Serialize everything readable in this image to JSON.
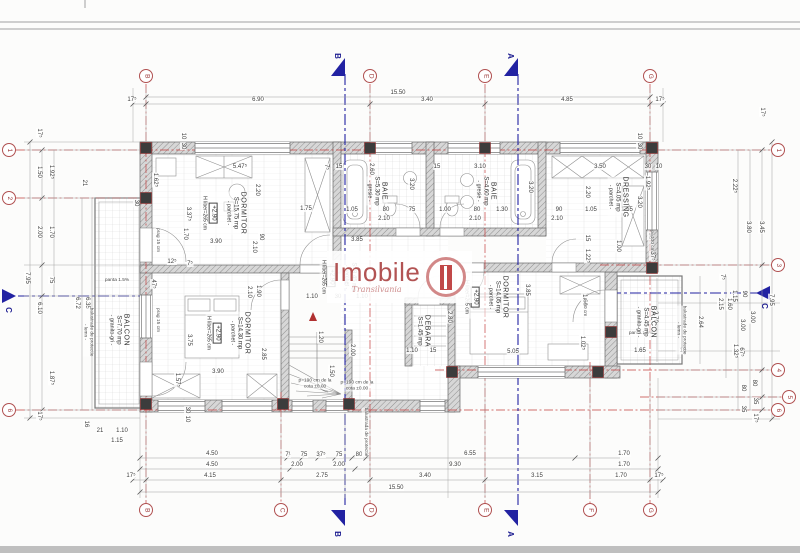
{
  "logo": {
    "name": "Imobile",
    "subtitle": "Transilvania"
  },
  "colors": {
    "grid_line": "#c24040",
    "section_line": "#2222a2",
    "bubble_stroke": "#b05050",
    "logo_red": "#b25353",
    "wall_gray": "#d7d7d7",
    "dim_text": "#3d3d3d"
  },
  "grid": {
    "top": [
      {
        "label": "B",
        "x": 146
      },
      {
        "label": "D",
        "x": 370
      },
      {
        "label": "E",
        "x": 485
      },
      {
        "label": "G",
        "x": 650
      }
    ],
    "bottom": [
      {
        "label": "B",
        "x": 146
      },
      {
        "label": "C",
        "x": 281
      },
      {
        "label": "D",
        "x": 370
      },
      {
        "label": "E",
        "x": 485
      },
      {
        "label": "F",
        "x": 590
      },
      {
        "label": "G",
        "x": 650
      }
    ],
    "left": [
      {
        "label": "1",
        "y": 150
      },
      {
        "label": "2",
        "y": 198
      },
      {
        "label": "6",
        "y": 410
      }
    ],
    "right": [
      {
        "label": "1",
        "y": 150,
        "x": 778
      },
      {
        "label": "3",
        "y": 265,
        "x": 778
      },
      {
        "label": "4",
        "y": 370,
        "x": 778
      },
      {
        "label": "5",
        "y": 397,
        "x": 789
      },
      {
        "label": "6",
        "y": 410,
        "x": 778
      }
    ]
  },
  "sections": [
    {
      "label": "B",
      "side": "top",
      "x": 345
    },
    {
      "label": "A",
      "side": "top",
      "x": 518
    },
    {
      "label": "B",
      "side": "bottom",
      "x": 345
    },
    {
      "label": "A",
      "side": "bottom",
      "x": 518
    },
    {
      "label": "C",
      "side": "left",
      "y": 296
    },
    {
      "label": "C",
      "side": "right",
      "y": 293
    }
  ],
  "rooms": [
    {
      "name": "DORMITOR",
      "area": "S=15.75 mp",
      "finish": "- parchet -",
      "level": "+2.90",
      "height": "H liber=265 cm",
      "x": 224,
      "y": 213
    },
    {
      "name": "BAIE",
      "area": "S=5.30 mp",
      "finish": "- gresie -",
      "x": 377,
      "y": 191
    },
    {
      "name": "BAIE",
      "area": "S=4.60 mp",
      "finish": "- gresie -",
      "x": 486,
      "y": 191
    },
    {
      "name": "DRESSING",
      "area": "S=4.05 mp",
      "finish": "- parchet -",
      "x": 618,
      "y": 197
    },
    {
      "name": "",
      "area": "S=8.45 mp",
      "finish": "- parchet -",
      "level": "+2.90",
      "height": "H liber=265 cm",
      "x": 338,
      "y": 277
    },
    {
      "name": "DORMITOR",
      "area": "S=14.30 mp",
      "finish": "- parchet -",
      "level": "+2.90",
      "height": "H liber=265 cm",
      "x": 228,
      "y": 333
    },
    {
      "name": "DORMITOR",
      "area": "S=14.05 mp",
      "finish": "- parchet -",
      "level": "+2.90",
      "height": "H liber=265 cm",
      "x": 486,
      "y": 297
    },
    {
      "name": "DEBARA",
      "area": "S=1.45 mp",
      "x": 423,
      "y": 331
    },
    {
      "name": "BALCON",
      "area": "S=7.70 mp",
      "finish": "- granito-gri -",
      "x": 119,
      "y": 330
    },
    {
      "name": "BALCON",
      "area": "S=4.45 mp",
      "finish": "- granito-gri -",
      "x": 646,
      "y": 322
    }
  ],
  "dims": [
    {
      "t": "15.50",
      "x": 398,
      "y": 93
    },
    {
      "t": "17⁵",
      "x": 132,
      "y": 100
    },
    {
      "t": "6.90",
      "x": 258,
      "y": 100
    },
    {
      "t": "3.40",
      "x": 427,
      "y": 100
    },
    {
      "t": "4.85",
      "x": 567,
      "y": 100
    },
    {
      "t": "17⁵",
      "x": 660,
      "y": 100
    },
    {
      "t": "4.50",
      "x": 212,
      "y": 454
    },
    {
      "t": "7¹",
      "x": 288,
      "y": 455
    },
    {
      "t": "75",
      "x": 304,
      "y": 455
    },
    {
      "t": "37⁵",
      "x": 321,
      "y": 455
    },
    {
      "t": "75",
      "x": 339,
      "y": 455
    },
    {
      "t": "80",
      "x": 359,
      "y": 455
    },
    {
      "t": "6.55",
      "x": 470,
      "y": 454
    },
    {
      "t": "1.70",
      "x": 624,
      "y": 454
    },
    {
      "t": "4.50",
      "x": 212,
      "y": 465
    },
    {
      "t": "2.00",
      "x": 297,
      "y": 465
    },
    {
      "t": "2.00",
      "x": 339,
      "y": 465
    },
    {
      "t": "9.30",
      "x": 455,
      "y": 465
    },
    {
      "t": "1.70",
      "x": 624,
      "y": 465
    },
    {
      "t": "17⁵",
      "x": 131,
      "y": 476
    },
    {
      "t": "4.15",
      "x": 210,
      "y": 476
    },
    {
      "t": "2.75",
      "x": 322,
      "y": 476
    },
    {
      "t": "3.40",
      "x": 425,
      "y": 476
    },
    {
      "t": "3.15",
      "x": 537,
      "y": 476
    },
    {
      "t": "1.70",
      "x": 621,
      "y": 476
    },
    {
      "t": "17⁵",
      "x": 659,
      "y": 476
    },
    {
      "t": "15.50",
      "x": 396,
      "y": 488
    },
    {
      "t": "17⁵",
      "x": 39,
      "y": 133,
      "r": 1
    },
    {
      "t": "1.50",
      "x": 39,
      "y": 172,
      "r": 1
    },
    {
      "t": "1.92⁵",
      "x": 51,
      "y": 172,
      "r": 1
    },
    {
      "t": "21",
      "x": 84,
      "y": 183,
      "r": 1
    },
    {
      "t": "2.00",
      "x": 39,
      "y": 232,
      "r": 1
    },
    {
      "t": "1.70",
      "x": 51,
      "y": 232,
      "r": 1
    },
    {
      "t": "7.95",
      "x": 27,
      "y": 278,
      "r": 1
    },
    {
      "t": "75",
      "x": 51,
      "y": 280,
      "r": 1
    },
    {
      "t": "6.10",
      "x": 39,
      "y": 308,
      "r": 1
    },
    {
      "t": "6.72",
      "x": 77,
      "y": 303,
      "r": 1
    },
    {
      "t": "6.35",
      "x": 87,
      "y": 303,
      "r": 1
    },
    {
      "t": "1.87⁵",
      "x": 51,
      "y": 378,
      "r": 1
    },
    {
      "t": "17⁵",
      "x": 39,
      "y": 416,
      "r": 1
    },
    {
      "t": "16",
      "x": 86,
      "y": 424,
      "r": 1
    },
    {
      "t": "21",
      "x": 100,
      "y": 431
    },
    {
      "t": "1.10",
      "x": 122,
      "y": 431
    },
    {
      "t": "1.15",
      "x": 117,
      "y": 441
    },
    {
      "t": "17⁵",
      "x": 762,
      "y": 112,
      "r": 1
    },
    {
      "t": "2.22⁵",
      "x": 734,
      "y": 186,
      "r": 1
    },
    {
      "t": "3.80",
      "x": 748,
      "y": 227,
      "r": 1
    },
    {
      "t": "3.45",
      "x": 761,
      "y": 227,
      "r": 1
    },
    {
      "t": "90",
      "x": 744,
      "y": 294,
      "r": 1
    },
    {
      "t": "1.15",
      "x": 734,
      "y": 296,
      "r": 1
    },
    {
      "t": "67⁵",
      "x": 741,
      "y": 352,
      "r": 1
    },
    {
      "t": "7⁵",
      "x": 722,
      "y": 277,
      "r": 1
    },
    {
      "t": "7.95",
      "x": 771,
      "y": 300,
      "r": 1
    },
    {
      "t": "2.15",
      "x": 720,
      "y": 304,
      "r": 1
    },
    {
      "t": "1.60",
      "x": 729,
      "y": 304,
      "r": 1
    },
    {
      "t": "3.00",
      "x": 752,
      "y": 317,
      "r": 1
    },
    {
      "t": "3.00",
      "x": 742,
      "y": 325,
      "r": 1
    },
    {
      "t": "1.32⁵",
      "x": 735,
      "y": 351,
      "r": 1
    },
    {
      "t": "2.64",
      "x": 700,
      "y": 322,
      "r": 1
    },
    {
      "t": "2.70",
      "x": 655,
      "y": 317,
      "r": 1
    },
    {
      "t": "80",
      "x": 754,
      "y": 383,
      "r": 1
    },
    {
      "t": "80",
      "x": 743,
      "y": 388,
      "r": 1
    },
    {
      "t": "35",
      "x": 755,
      "y": 401,
      "r": 1
    },
    {
      "t": "35",
      "x": 743,
      "y": 409,
      "r": 1
    },
    {
      "t": "17⁵",
      "x": 755,
      "y": 418,
      "r": 1
    },
    {
      "t": "16",
      "x": 683,
      "y": 351
    },
    {
      "t": "1.65",
      "x": 640,
      "y": 351
    },
    {
      "t": "5.47⁵",
      "x": 240,
      "y": 167
    },
    {
      "t": "1.62⁵",
      "x": 155,
      "y": 180,
      "r": 1
    },
    {
      "t": "2.20",
      "x": 257,
      "y": 190,
      "r": 1
    },
    {
      "t": "3.37⁵",
      "x": 188,
      "y": 214,
      "r": 1
    },
    {
      "t": "1.70",
      "x": 185,
      "y": 234,
      "r": 1
    },
    {
      "t": "3.90",
      "x": 216,
      "y": 242
    },
    {
      "t": "1.75",
      "x": 306,
      "y": 209
    },
    {
      "t": "90",
      "x": 261,
      "y": 237,
      "r": 1
    },
    {
      "t": "2.10",
      "x": 254,
      "y": 247,
      "r": 1
    },
    {
      "t": "12⁵",
      "x": 172,
      "y": 262
    },
    {
      "t": "7⁵",
      "x": 190,
      "y": 264
    },
    {
      "t": "7⁵",
      "x": 326,
      "y": 167,
      "r": 1
    },
    {
      "t": "15",
      "x": 339,
      "y": 167
    },
    {
      "t": "2.60",
      "x": 371,
      "y": 169,
      "r": 1
    },
    {
      "t": "3.20",
      "x": 411,
      "y": 184,
      "r": 1
    },
    {
      "t": "1.05",
      "x": 352,
      "y": 210
    },
    {
      "t": "80",
      "x": 386,
      "y": 210
    },
    {
      "t": "75",
      "x": 412,
      "y": 210
    },
    {
      "t": "2.10",
      "x": 384,
      "y": 219
    },
    {
      "t": "1.00",
      "x": 445,
      "y": 210
    },
    {
      "t": "80",
      "x": 477,
      "y": 210
    },
    {
      "t": "1.30",
      "x": 502,
      "y": 210
    },
    {
      "t": "2.10",
      "x": 475,
      "y": 219
    },
    {
      "t": "3.10",
      "x": 480,
      "y": 167
    },
    {
      "t": "3.20",
      "x": 530,
      "y": 187,
      "r": 1
    },
    {
      "t": "15",
      "x": 437,
      "y": 167
    },
    {
      "t": "3.50",
      "x": 600,
      "y": 167
    },
    {
      "t": "2.20",
      "x": 587,
      "y": 192,
      "r": 1
    },
    {
      "t": "90",
      "x": 559,
      "y": 210
    },
    {
      "t": "1.05",
      "x": 591,
      "y": 210
    },
    {
      "t": "1.55",
      "x": 627,
      "y": 210
    },
    {
      "t": "2.10",
      "x": 557,
      "y": 219
    },
    {
      "t": "1.92⁵",
      "x": 647,
      "y": 183,
      "r": 1
    },
    {
      "t": "3.20",
      "x": 639,
      "y": 202,
      "r": 1
    },
    {
      "t": "15",
      "x": 587,
      "y": 238,
      "r": 1
    },
    {
      "t": "1.22⁵",
      "x": 587,
      "y": 256,
      "r": 1
    },
    {
      "t": "1.00",
      "x": 618,
      "y": 246,
      "r": 1
    },
    {
      "t": "90",
      "x": 650,
      "y": 236,
      "r": 1
    },
    {
      "t": "37⁵",
      "x": 652,
      "y": 256,
      "r": 1
    },
    {
      "t": "30",
      "x": 648,
      "y": 167
    },
    {
      "t": "10",
      "x": 659,
      "y": 167
    },
    {
      "t": "3.85",
      "x": 357,
      "y": 240
    },
    {
      "t": "3.85",
      "x": 527,
      "y": 290,
      "r": 1
    },
    {
      "t": "2.80",
      "x": 449,
      "y": 317,
      "r": 1
    },
    {
      "t": "5.05",
      "x": 513,
      "y": 352
    },
    {
      "t": "1.10",
      "x": 412,
      "y": 351
    },
    {
      "t": "15",
      "x": 433,
      "y": 351
    },
    {
      "t": "1.60",
      "x": 584,
      "y": 300,
      "r": 1
    },
    {
      "t": "1.02⁵",
      "x": 582,
      "y": 343,
      "r": 1
    },
    {
      "t": "2.10",
      "x": 249,
      "y": 292,
      "r": 1
    },
    {
      "t": "1.90",
      "x": 258,
      "y": 291,
      "r": 1
    },
    {
      "t": "1.10",
      "x": 312,
      "y": 297
    },
    {
      "t": "30",
      "x": 338,
      "y": 297
    },
    {
      "t": "1.10",
      "x": 362,
      "y": 297
    },
    {
      "t": "1.20",
      "x": 320,
      "y": 337,
      "r": 1
    },
    {
      "t": "2.00",
      "x": 352,
      "y": 350,
      "r": 1
    },
    {
      "t": "1.50",
      "x": 331,
      "y": 371,
      "r": 1
    },
    {
      "t": "47⁵",
      "x": 153,
      "y": 284,
      "r": 1
    },
    {
      "t": "10",
      "x": 183,
      "y": 136,
      "r": 1
    },
    {
      "t": "30",
      "x": 183,
      "y": 146,
      "r": 1
    },
    {
      "t": "10",
      "x": 639,
      "y": 136,
      "r": 1
    },
    {
      "t": "30",
      "x": 639,
      "y": 146,
      "r": 1
    },
    {
      "t": "30",
      "x": 136,
      "y": 203,
      "r": 1
    },
    {
      "t": "30",
      "x": 187,
      "y": 410,
      "r": 1
    },
    {
      "t": "10",
      "x": 187,
      "y": 419,
      "r": 1
    },
    {
      "t": "2.85",
      "x": 263,
      "y": 354,
      "r": 1
    },
    {
      "t": "3.75",
      "x": 189,
      "y": 340,
      "r": 1
    },
    {
      "t": "3.90",
      "x": 218,
      "y": 372
    },
    {
      "t": "1.57⁵",
      "x": 177,
      "y": 380,
      "r": 1
    }
  ],
  "notes": [
    {
      "t": "panta 1.5%",
      "x": 117,
      "y": 281
    },
    {
      "t": "panta 1.5%",
      "x": 641,
      "y": 334
    },
    {
      "t": "balustrade de protectie\n- lemn -",
      "x": 88,
      "y": 332,
      "r": 1
    },
    {
      "t": "balustrade de protectie\n- lemn -",
      "x": 681,
      "y": 330,
      "r": 1
    },
    {
      "t": "balustrada de protectie",
      "x": 365,
      "y": 432,
      "r": 1
    },
    {
      "t": "prag 15 cm",
      "x": 157,
      "y": 240,
      "r": 1
    },
    {
      "t": "prag 15 cm",
      "x": 157,
      "y": 320,
      "r": 1
    },
    {
      "t": "p=100 cm",
      "x": 651,
      "y": 241,
      "r": 1
    },
    {
      "t": "p=60 cm",
      "x": 584,
      "y": 307,
      "r": 1
    },
    {
      "t": "p=190 cm de la\ncota ±0.00",
      "x": 315,
      "y": 384
    },
    {
      "t": "p=190 cm de la\ncota ±0.00",
      "x": 357,
      "y": 386
    }
  ]
}
